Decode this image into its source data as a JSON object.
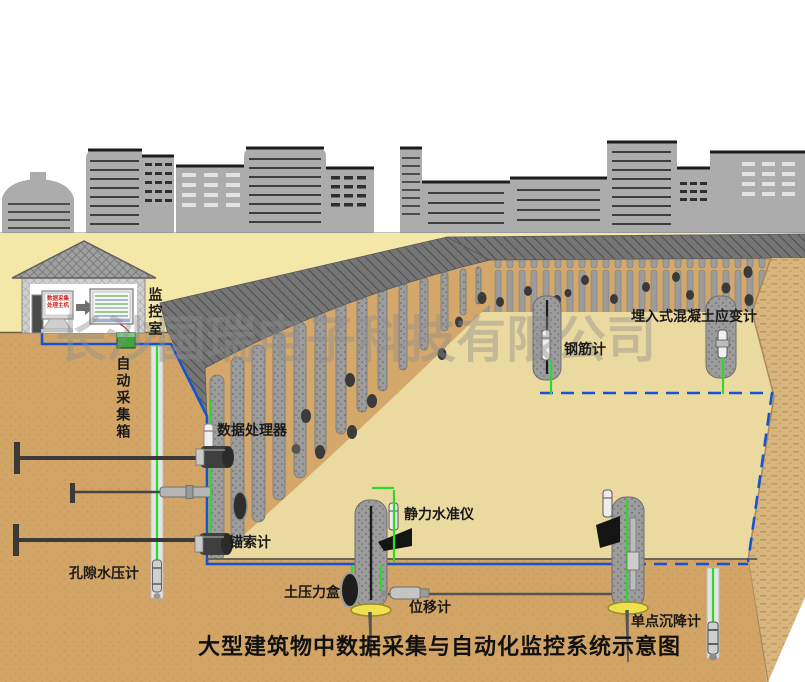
{
  "diagram": {
    "title": "大型建筑物中数据采集与自动化监控系统示意图",
    "watermark": "长沙国瑞电子科技有限公司",
    "labels": {
      "monitoring_room": "监控室",
      "auto_collection_box": "自动采集箱",
      "data_processor": "数据处理器",
      "anchor_cable_gauge": "锚索计",
      "pore_water_pressure_gauge": "孔隙水压计",
      "earth_pressure_cell": "土压力盒",
      "static_level_gauge": "静力水准仪",
      "displacement_meter": "位移计",
      "rebar_gauge": "钢筋计",
      "embedded_concrete_strain_gauge": "埋入式混凝土应变计",
      "single_point_settlement_gauge": "单点沉降计"
    },
    "monitor_screen": {
      "line1": "数据采集",
      "line2": "处理主机"
    },
    "colors": {
      "cable_blue": "#1553D6",
      "wire_green": "#2ADB2A",
      "ground_yellow": "#F5E7A8",
      "pit_floor": "#EBDA9F",
      "soil_front": "#D2A567",
      "slope_right": "#D8B57C",
      "wall_face": "#D4A76B",
      "pile_gray": "#9C9C9C",
      "berm_dark": "#777777",
      "building_gray": "#ACACAC",
      "collection_box_green": "#3FA33F",
      "settlement_plate_yellow": "#EFE14E"
    }
  }
}
